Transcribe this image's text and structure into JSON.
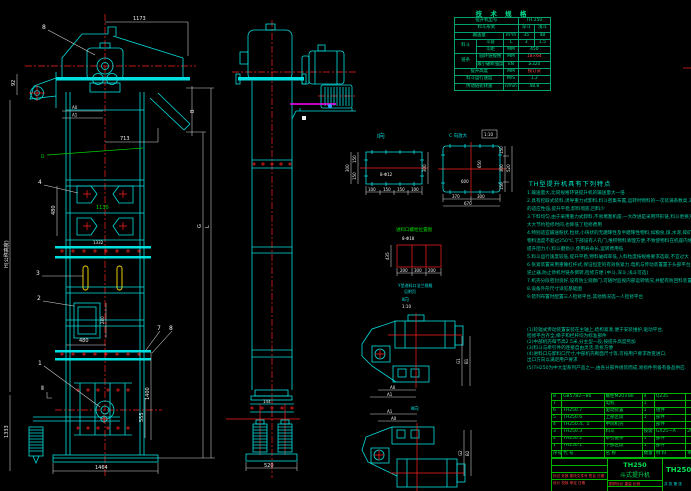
{
  "colors": {
    "background": "#000000",
    "outline_cyan": "#00e0e0",
    "centerline_red": "#ff2222",
    "dimension_white": "#e8e8e8",
    "table_green": "#00e050",
    "spec_green": "#00e090",
    "note_teal": "#00c8a0",
    "bucket_yellow": "#ffe000",
    "section_magenta": "#ff00ff"
  },
  "spec_table": {
    "title": "技 术 规 格",
    "model_label": "提升机型号",
    "model_value": "TH 250",
    "bucket_type_label": "料斗形式",
    "bucket_type_deep": "深斗",
    "bucket_type_shallow": "浅斗",
    "capacity_label": "输送量",
    "capacity_unit": "m³/h",
    "capacity_deep": "35",
    "capacity_shallow": "48",
    "bucket_group": "料斗",
    "bucket_vol_label": "斗容",
    "bucket_vol_unit": "L",
    "bucket_vol_deep": "3",
    "bucket_vol_shallow": "1.5",
    "bucket_pitch_label": "斗距",
    "bucket_pitch_unit": "MM",
    "bucket_pitch_value": "450",
    "chain_group": "链条",
    "chain_spec_label": "圆环链规格",
    "chain_spec_unit": "MM",
    "chain_spec_value": "18×64",
    "chain_break_label": "最小破断强度",
    "chain_break_unit": "kN",
    "chain_break_value": "≥320",
    "lift_height_label": "提升高度",
    "lift_height_unit": "MM",
    "lift_height_value": "按订货",
    "speed_label": "料斗运行速度",
    "speed_unit": "M/S",
    "speed_value": "1.2",
    "sprocket_label": "传动链轮转速",
    "sprocket_unit": "r/min",
    "sprocket_value": "48.8"
  },
  "features": {
    "title": "TH型提升机具有下列特点",
    "lines": [
      "1.输送量大,比同规格环链提升机的输送量大一倍",
      "2.具有挖取式装料,诱导重力式卸料,料斗密集布置,运转时物料的一次装满系数高,对物料",
      "  的适应性强,提升平稳,卸料彻底,回料少",
      "3.下料均匀,由于采用重力式卸料,不易堵塞机座,一大改进是采用环形链,料斗更换方便,",
      "  大大节约检修时间,也降低了检修费用",
      "4.特别适宜输送粉状,粒状,小块状的无磨琢性及半磨琢性物料,如粮食,煤,水泥,碎矿石等,",
      "  物料温度不超过250℃,下部设有人孔门,堆积物料清理方便,不致使物料在机座内堆积,",
      "  提升阻力小,料斗磨损小,使用寿命长,运转费用低",
      "5.料斗运行速度较低,提升平稳,物料破碎率低,入料粒度按规格要求选取,不宜过大",
      "6.张紧装置采用重锤杠杆式,保证恒定的有效张紧力,电机与传动装置置于头部平台上,配有",
      "  逆止器,防止停机时链条倒转,检修方便            (中斗,深斗,浅斗可选)",
      "7.机壳分段密封良好,设有防尘观察门,可随时监视内部运转情况,并配有防回料装置",
      "8.设备外形尺寸详见基础图",
      "9.错列布置时配置三人检修平台,其他情况选一人检修平台"
    ],
    "notes": [
      "(1)轮辐式传动装置安装在主轴上,结构紧凑,便于安装维护,驱动平台,",
      "   检修平台齐全,梯子和栏杆均为标准部件",
      "(2)中部机壳每节高2.5米,分主型一段,按提升高度另加",
      "(3)料斗与牵引件的连接自由灵活,装拆方便",
      "(4)进料口与卸料口尺寸,中部机壳断面尺寸等,可按用户要求改变进口,",
      "   出口方向以满足用户要求"
    ],
    "footnote": "(5)TH250为中大型系列产品之一,由各分部件组装而成,易损件另备有备品供应."
  },
  "parts_table": {
    "headers": [
      "序号",
      "代  号",
      "名  称",
      "数量",
      "材  料",
      "单重"
    ],
    "rows": [
      [
        "8",
        "GB5782—86",
        "螺栓M20×80",
        "4",
        "Q235",
        ""
      ],
      [
        "7",
        "",
        "电机",
        "1",
        "",
        ""
      ],
      [
        "6",
        "TH250.7",
        "驱动装置",
        "1",
        "组件",
        ""
      ],
      [
        "5",
        "TH250.6",
        "上部区段",
        "1",
        "部件",
        ""
      ],
      [
        "4",
        "TH250.4、5",
        "中间机壳",
        "",
        "部件",
        ""
      ],
      [
        "3",
        "TH250.3",
        "料斗",
        "按需",
        "GX25—A",
        "204"
      ],
      [
        "2",
        "TH250.2",
        "牵引链条",
        "1",
        "部件",
        ""
      ],
      [
        "1",
        "TH250.1",
        "下部区段",
        "1",
        "部件",
        ""
      ]
    ]
  },
  "title_block": {
    "model": "TH250",
    "name": "斗式提升机",
    "drawing_no": "TH250",
    "rev_row": "标记 处数 更改文件号 签名 日期",
    "sign_row": "设计  校核  审定  日期",
    "stamp_labels": "图样标记  重量  比例",
    "sheet": "共 张 第 张"
  },
  "dims": {
    "d1173": "1173",
    "d713": "713",
    "d92": "92",
    "dB": "B",
    "dG": "G",
    "dL": "L",
    "dA0": "A0",
    "dA1": "A1",
    "d480a": "480",
    "d1130": "1130",
    "d1332": "1332",
    "d280": "280",
    "d480b": "480",
    "d1400": "1400",
    "d555": "555",
    "d1464": "1464",
    "d1333": "1333",
    "dH": "H(公称高度)",
    "d144": "144",
    "d520": "520"
  },
  "labels": {
    "p1": "1",
    "p2": "2",
    "p3": "3",
    "p4": "4",
    "p7": "7",
    "p8a": "8",
    "p8b": "8",
    "sec2": "Ⅱ",
    "dweld": "D"
  },
  "detailI": {
    "title": "Ⅰ向",
    "bolt": "8-Φ12",
    "l150a": "150",
    "l150b": "150",
    "l300": "300",
    "r300": "300",
    "b100a": "100",
    "b150a": "150",
    "b150b": "150",
    "b100b": "100"
  },
  "detailC": {
    "title": "C 向放大",
    "scale": "1:10",
    "w600": "600",
    "h650": "650",
    "r150a": "150",
    "r300": "300",
    "r150b": "150",
    "r520": "520",
    "b370": "370",
    "b300": "300",
    "b670": "670"
  },
  "inlet_detail": {
    "title": "进料口螺栓位置图",
    "bolt": "8-Φ18",
    "b200a": "200",
    "b300": "300",
    "b200b": "200",
    "l435": "435",
    "cap1": "Y型进料口法兰规格",
    "cap2": "见附页"
  },
  "viewA": {
    "title": "Ⅱ向",
    "scale": "1:10",
    "a0": "A0",
    "a1": "A1",
    "g": "G1",
    "b": "B1"
  },
  "viewB": {
    "title": "Ⅲ向",
    "a0": "A0",
    "a1": "A1",
    "g": "G2",
    "b": "B2"
  }
}
